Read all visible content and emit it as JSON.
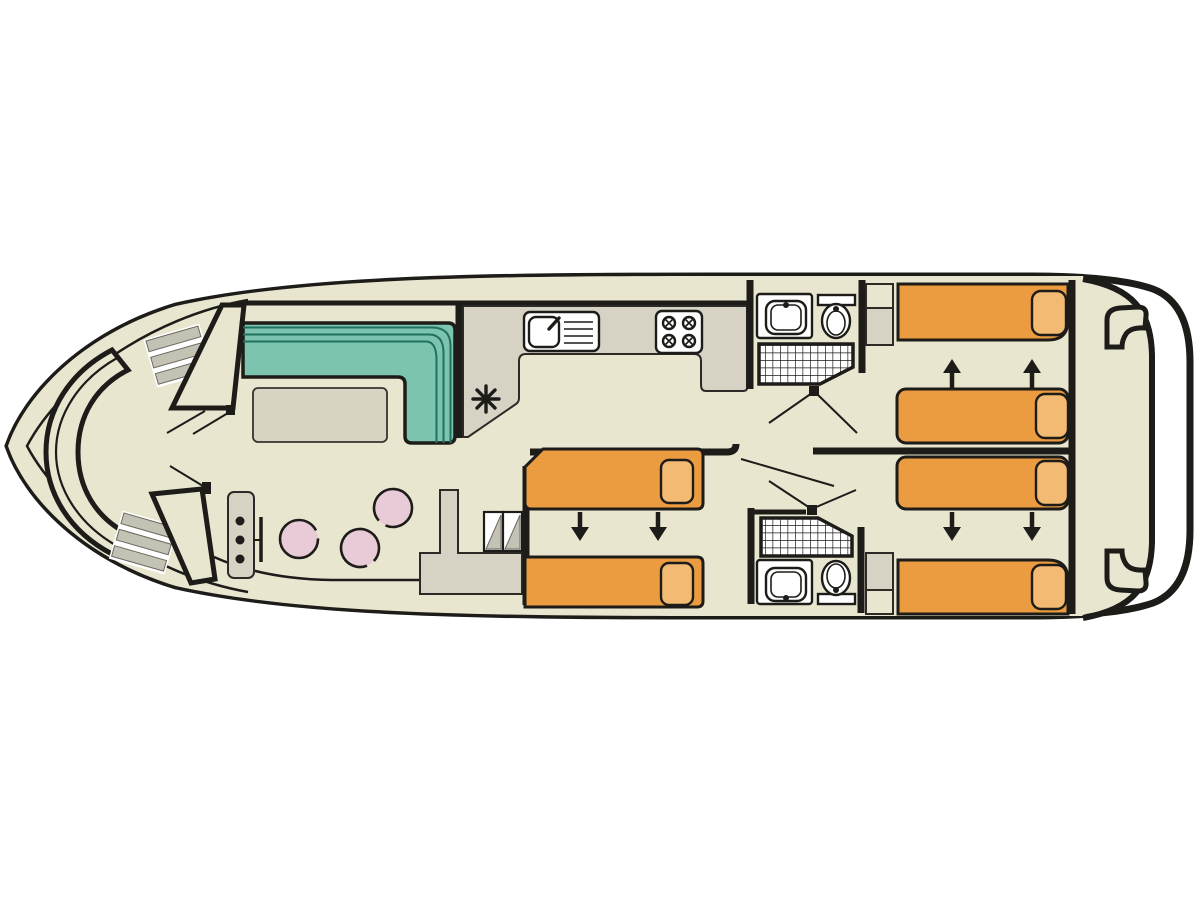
{
  "diagram": {
    "type": "boat-deck-floor-plan",
    "orientation": "bow-left-stern-right"
  },
  "colors": {
    "line": "#1e1c19",
    "floor": "#e9e6d0",
    "counter": "#d6d3c5",
    "table": "#d7d4c4",
    "sofa": "#7cc4b0",
    "sofa-line": "#1f705d",
    "bed": "#eb9b40",
    "pillow": "#f3ba74",
    "stool": "#e9cbd7",
    "stripe": "#c4c2b5"
  },
  "symbols": {
    "heater": "8-spoke-asterisk",
    "bed_convert_arrows": "black triangle arrows (beds slide together)",
    "shower": "hatched grid square",
    "wardrobe": "rectangles with diagonal triangles"
  },
  "inventory": {
    "bow_bench_seats": 1,
    "entry_step_flights": 2,
    "saloon_sofas": 1,
    "saloon_tables": 1,
    "helm_stools": 3,
    "helm_console_dots": 3,
    "galley_sinks": 1,
    "galley_burners": 4,
    "heater_symbols": 1,
    "wardrobe_sections": 2,
    "single_beds": 6,
    "pillows": 6,
    "convert_arrows": 6,
    "bathrooms": 2,
    "washbasins": 2,
    "toilets": 2,
    "showers": 2,
    "stern_boarding_steps": 2
  }
}
